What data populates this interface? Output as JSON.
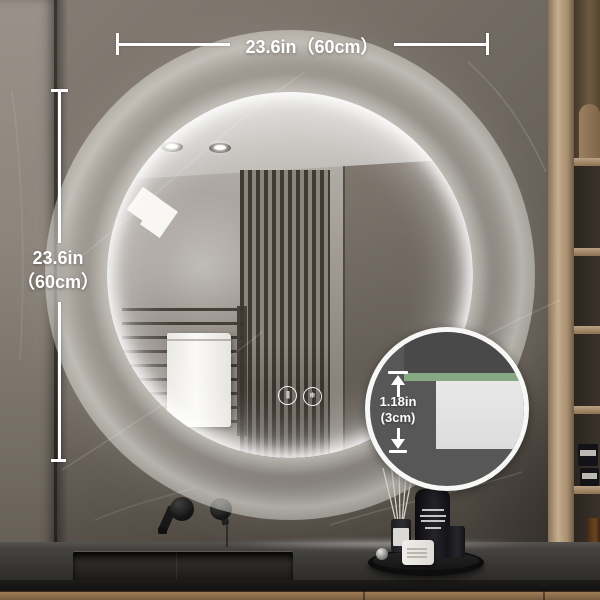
{
  "annotations": {
    "width_label": "23.6in（60cm）",
    "height_label_line1": "23.6in",
    "height_label_line2": "（60cm）",
    "thickness_label_line1": "1.18in",
    "thickness_label_line2": "(3cm)"
  },
  "mirror": {
    "controls": {
      "light_button_glyph": "|||",
      "defog_button_glyph": "❄"
    }
  },
  "colors": {
    "annotation_text": "#ffffff",
    "led_glow": "#fffffa",
    "back_wall": "#6d665e",
    "left_wall": "#8d857b",
    "countertop": "#31302e",
    "wood_cabinet": "#a78e6f",
    "inset_background": "#575757",
    "inset_glass_edge_green": "#86a883",
    "inset_panel_gray": "#e2e2e2"
  }
}
